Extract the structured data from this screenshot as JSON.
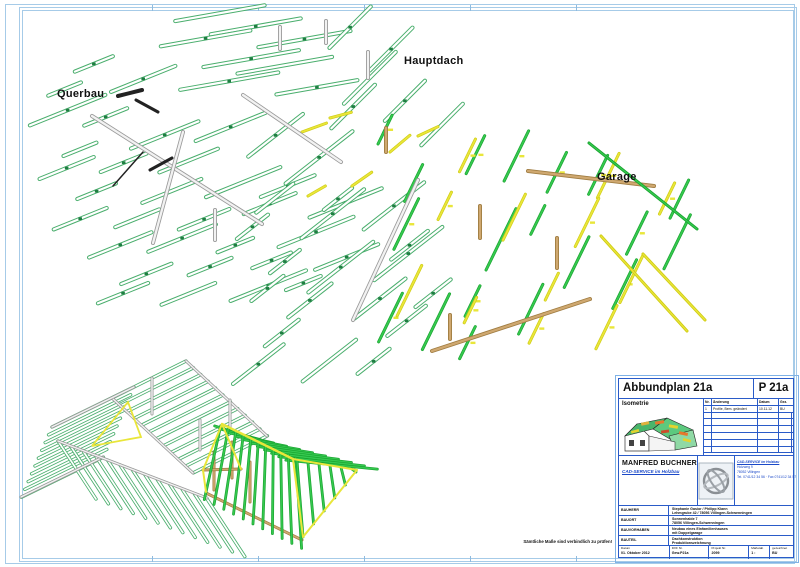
{
  "labels": {
    "querbau": "Querbau",
    "hauptdach": "Hauptdach",
    "garage": "Garage",
    "note": "Sämtliche Maße sind verbindlich zu prüfen!"
  },
  "titleblock": {
    "title": "Abbundplan 21a",
    "plan_no": "P 21a",
    "iso_label": "Isometrie",
    "revisions": {
      "headers": [
        "Nr.",
        "Änderung",
        "Datum",
        "Gez."
      ],
      "rows": [
        [
          "1",
          "Profile, Bem. geändert",
          "10.11.12",
          "BU"
        ]
      ],
      "empty_rows": 6
    },
    "company": {
      "name": "MANFRED BUCHNER",
      "tagline": "CAD-SERVICE im Holzbau",
      "address": [
        "CAD-SERVICE im Holzbau",
        "Holzweg 9",
        "78052 Villingen",
        "Tel. 0741/12 34 56 · Fax 0741/12 34 57"
      ]
    },
    "project_rows": [
      {
        "label": "BAUHERR",
        "lines": [
          "Stephanie Gasior / Philipp Klann",
          "Lehmgrube 42 / 78056 Villingen-Schwenningen"
        ]
      },
      {
        "label": "BAUORT",
        "lines": [
          "Sonnenhalde 7",
          "78056 Villingen-Schwenningen"
        ]
      },
      {
        "label": "BAUVORHABEN",
        "lines": [
          "Neubau eines Einfamilienhauses",
          "mit Doppelgarage"
        ]
      },
      {
        "label": "BAUTEIL",
        "lines": [
          "Dachkonstruktion",
          "Produktionszeichnung"
        ]
      }
    ],
    "footer": [
      {
        "label": "Datum",
        "value": "01. Oktober 2012",
        "w": 51
      },
      {
        "label": "DXF Nr.",
        "value": "Gew.P21a",
        "w": 40
      },
      {
        "label": "Projekt Nr.",
        "value": "2099",
        "w": 40
      },
      {
        "label": "Maßstab",
        "value": "1 :",
        "w": 21
      },
      {
        "label": "gezeichnet",
        "value": "BU",
        "w": 23
      }
    ]
  },
  "drawing": {
    "colors": {
      "mint": "#4aae6d",
      "mint_mark": "#1f7e42",
      "bright": "#35c94f",
      "bright_dark": "#18a22e",
      "yellow": "#e9e63a",
      "yellow_dark": "#cfcb12",
      "tan": "#cfa870",
      "tan_dark": "#a07d42",
      "gray": "#9a9a9a",
      "gray_fill": "#f2f2f2",
      "black": "#222222",
      "frame": "#a6cbe8",
      "tb_line": "#2a5bc8"
    },
    "beam_groups": [
      {
        "name": "querbau-top",
        "seed": 11,
        "origin": [
          175,
          20
        ],
        "u": [
          40,
          14
        ],
        "v": [
          -15,
          30
        ],
        "ni": 4,
        "nj": 3,
        "skip": 0.2,
        "jitter": 5,
        "angle": -10,
        "len": [
          70,
          105
        ],
        "style": "mint",
        "clip": [
          160,
          10,
          335,
          100
        ]
      },
      {
        "name": "querbau-main",
        "seed": 7,
        "origin": [
          38,
          48
        ],
        "u": [
          38,
          24
        ],
        "v": [
          -26,
          28
        ],
        "ni": 10,
        "nj": 9,
        "skip": 0.2,
        "jitter": 6,
        "angle": -22,
        "len": [
          28,
          82
        ],
        "style": "mint",
        "clip": [
          25,
          42,
          318,
          312
        ]
      },
      {
        "name": "mid-band",
        "seed": 21,
        "origin": [
          330,
          50
        ],
        "u": [
          36,
          22
        ],
        "v": [
          -18,
          30
        ],
        "ni": 4,
        "nj": 4,
        "skip": 0.2,
        "jitter": 5,
        "angle": -45,
        "len": [
          45,
          80
        ],
        "style": "mint",
        "clip": [
          315,
          35,
          475,
          155
        ]
      },
      {
        "name": "hauptdach-main",
        "seed": 5,
        "origin": [
          245,
          160
        ],
        "u": [
          38,
          24
        ],
        "v": [
          -24,
          30
        ],
        "ni": 6,
        "nj": 8,
        "skip": 0.15,
        "jitter": 6,
        "angle": -38,
        "len": [
          35,
          90
        ],
        "style": "mint",
        "clip": [
          230,
          150,
          432,
          392
        ]
      },
      {
        "name": "garage-green",
        "seed": 13,
        "origin": [
          380,
          150
        ],
        "u": [
          42,
          10
        ],
        "v": [
          -12,
          46
        ],
        "ni": 8,
        "nj": 5,
        "skip": 0.18,
        "jitter": 7,
        "angle": -64,
        "len": [
          30,
          72
        ],
        "style": "bright",
        "clip": [
          360,
          132,
          712,
          360
        ]
      },
      {
        "name": "garage-yellow",
        "seed": 29,
        "origin": [
          398,
          162
        ],
        "u": [
          64,
          12
        ],
        "v": [
          -20,
          48
        ],
        "ni": 5,
        "nj": 4,
        "skip": 0.25,
        "jitter": 8,
        "angle": -64,
        "len": [
          25,
          60
        ],
        "style": "yellowstick",
        "clip": [
          362,
          135,
          705,
          355
        ]
      }
    ],
    "extra_yellow": [
      {
        "x": 302,
        "y": 132,
        "len": 26,
        "ang": -20
      },
      {
        "x": 330,
        "y": 118,
        "len": 22,
        "ang": -15
      },
      {
        "x": 352,
        "y": 186,
        "len": 24,
        "ang": -35
      },
      {
        "x": 308,
        "y": 196,
        "len": 20,
        "ang": -30
      },
      {
        "x": 390,
        "y": 152,
        "len": 26,
        "ang": -40
      },
      {
        "x": 418,
        "y": 136,
        "len": 22,
        "ang": -25
      }
    ],
    "long_beams": [
      {
        "x1": 92,
        "y1": 116,
        "x2": 262,
        "y2": 224,
        "c": "gray",
        "w": 4
      },
      {
        "x1": 183,
        "y1": 132,
        "x2": 153,
        "y2": 243,
        "c": "gray",
        "w": 4
      },
      {
        "x1": 243,
        "y1": 95,
        "x2": 341,
        "y2": 162,
        "c": "gray",
        "w": 4
      },
      {
        "x1": 418,
        "y1": 180,
        "x2": 353,
        "y2": 320,
        "c": "gray",
        "w": 4
      },
      {
        "x1": 432,
        "y1": 351,
        "x2": 590,
        "y2": 299,
        "c": "tan",
        "w": 4
      },
      {
        "x1": 528,
        "y1": 171,
        "x2": 654,
        "y2": 186,
        "c": "tan",
        "w": 4
      },
      {
        "x1": 601,
        "y1": 236,
        "x2": 687,
        "y2": 331,
        "c": "yellowstick",
        "w": 3
      },
      {
        "x1": 643,
        "y1": 254,
        "x2": 705,
        "y2": 320,
        "c": "yellowstick",
        "w": 3
      },
      {
        "x1": 589,
        "y1": 143,
        "x2": 697,
        "y2": 229,
        "c": "bright",
        "w": 3
      }
    ],
    "posts": [
      {
        "x": 215,
        "y": 210,
        "h": 30,
        "c": "gray"
      },
      {
        "x": 368,
        "y": 52,
        "h": 26,
        "c": "gray"
      },
      {
        "x": 280,
        "y": 27,
        "h": 22,
        "c": "gray"
      },
      {
        "x": 326,
        "y": 21,
        "h": 22,
        "c": "gray"
      },
      {
        "x": 480,
        "y": 206,
        "h": 32,
        "c": "tan"
      },
      {
        "x": 557,
        "y": 238,
        "h": 30,
        "c": "tan"
      },
      {
        "x": 450,
        "y": 315,
        "h": 24,
        "c": "tan"
      },
      {
        "x": 386,
        "y": 128,
        "h": 24,
        "c": "tan"
      }
    ],
    "black_bits": [
      {
        "x1": 118,
        "y1": 96,
        "x2": 142,
        "y2": 90,
        "w": 4
      },
      {
        "x1": 136,
        "y1": 100,
        "x2": 158,
        "y2": 112,
        "w": 3
      },
      {
        "x1": 113,
        "y1": 186,
        "x2": 143,
        "y2": 152,
        "w": 1.5
      },
      {
        "x1": 150,
        "y1": 170,
        "x2": 172,
        "y2": 158,
        "w": 3
      }
    ],
    "main_assembly": {
      "planes": [
        {
          "start": [
            112,
            398
          ],
          "step": [
            7.4,
            6.8
          ],
          "dir": [
            74,
            -37
          ],
          "n": 12
        },
        {
          "start": [
            52,
            427
          ],
          "step": [
            -3.4,
            7.8
          ],
          "dir": [
            82,
            -40
          ],
          "n": 10
        },
        {
          "start": [
            58,
            441
          ],
          "step": [
            12.4,
            4.8
          ],
          "dir": [
            38,
            58
          ],
          "n": 13
        }
      ],
      "gray_lines": [
        [
          186,
          361,
          267,
          436
        ],
        [
          112,
          398,
          193,
          473
        ],
        [
          52,
          427,
          134,
          387
        ],
        [
          21,
          497,
          103,
          457
        ],
        [
          58,
          441,
          207,
          498
        ],
        [
          152,
          378,
          152,
          414
        ],
        [
          200,
          420,
          200,
          450
        ],
        [
          230,
          400,
          230,
          428
        ]
      ],
      "gable": [
        [
          92,
          446
        ],
        [
          128,
          402
        ],
        [
          141,
          437
        ],
        [
          92,
          446
        ]
      ]
    },
    "garage_assembly": {
      "ridge": [
        222,
        424,
        293,
        459
      ],
      "planes": [
        {
          "p0": [
            218,
            427
          ],
          "p1": [
            295,
            461
          ],
          "q0": [
            240,
            434
          ],
          "q1": [
            356,
            467
          ],
          "ext": [
            -0.15,
            0.35
          ],
          "n": 11
        },
        {
          "p0": [
            220,
            429
          ],
          "p1": [
            296,
            462
          ],
          "q0": [
            206,
            492
          ],
          "q1": [
            301,
            539
          ],
          "ext": [
            -0.05,
            0.12
          ],
          "n": 11
        },
        {
          "p0": [
            297,
            461
          ],
          "p1": [
            352,
            469
          ],
          "q0": [
            303,
            537
          ],
          "q1": [
            356,
            472
          ],
          "ext": [
            0,
            0
          ],
          "n": 6
        }
      ],
      "yellow_edges": [
        [
          203,
          470,
          222,
          424
        ],
        [
          222,
          424,
          241,
          469
        ],
        [
          293,
          459,
          357,
          470
        ],
        [
          293,
          459,
          303,
          537
        ],
        [
          303,
          537,
          357,
          470
        ],
        [
          203,
          470,
          206,
          492
        ]
      ],
      "tan_lines": [
        [
          238,
          436,
          355,
          467
        ],
        [
          206,
          493,
          302,
          540
        ],
        [
          214,
          452,
          214,
          490
        ],
        [
          250,
          462,
          250,
          502
        ],
        [
          232,
          442,
          232,
          478
        ],
        [
          203,
          470,
          241,
          469
        ]
      ]
    },
    "frame_ticks_x": [
      152,
      258,
      364,
      470,
      576
    ]
  }
}
